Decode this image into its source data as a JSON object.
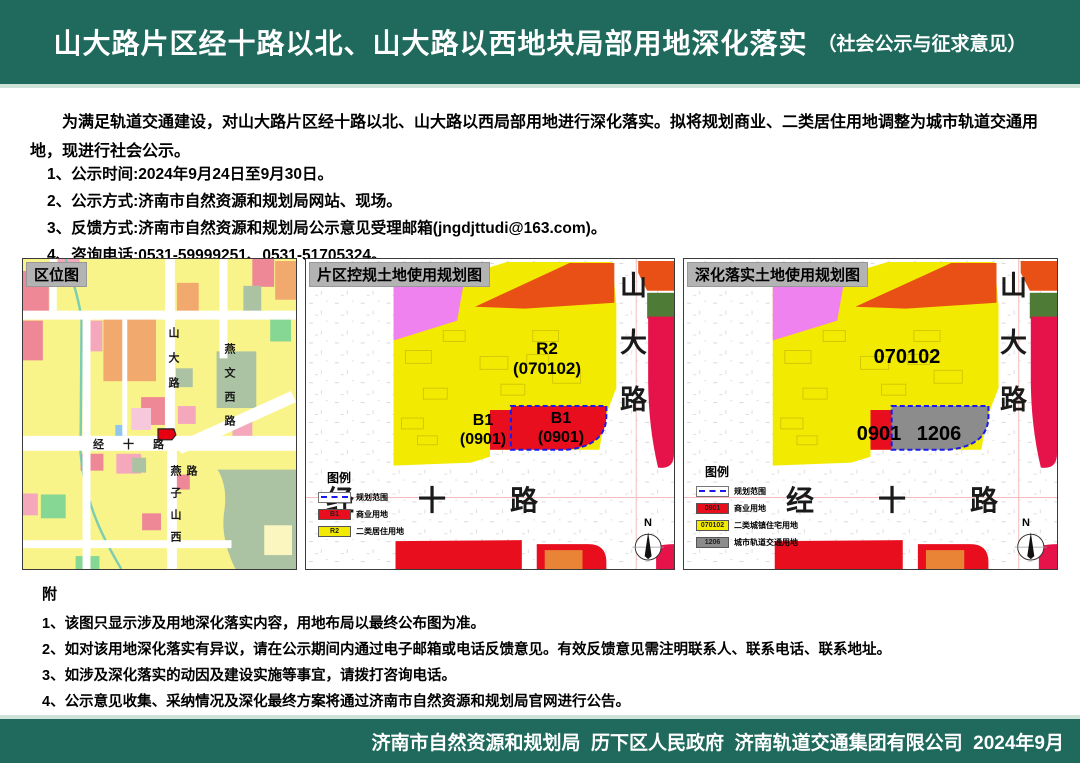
{
  "header": {
    "title": "山大路片区经十路以北、山大路以西地块局部用地深化落实",
    "subtitle": "（社会公示与征求意见）"
  },
  "intro": "为满足轨道交通建设，对山大路片区经十路以北、山大路以西局部用地进行深化落实。拟将规划商业、二类居住用地调整为城市轨道交通用地，现进行社会公示。",
  "notices": [
    "1、公示时间:2024年9月24日至9月30日。",
    "2、公示方式:济南市自然资源和规划局网站、现场。",
    "3、反馈方式:济南市自然资源和规划局公示意见受理邮箱(jngdjttudi@163.com)。",
    "4、咨询电话:0531-59999251、0531-51705324。"
  ],
  "location_panel": {
    "title": "区位图",
    "roads": {
      "shanda": "山大路",
      "yanwenxi": "燕文西路",
      "jingshi": "经十路",
      "yanzishanxi": "燕子山西路"
    }
  },
  "current_panel": {
    "title": "片区控规土地使用规划图",
    "parcel_r2_code": "R2",
    "parcel_r2_num": "(070102)",
    "parcel_b1_code": "B1",
    "parcel_b1_num": "(0901)",
    "parcel_b1_small_code": "B1",
    "parcel_b1_small_num": "(0901)",
    "roads": {
      "shanda": "山大路",
      "jingshi": "经十路"
    },
    "north": "N",
    "legend": {
      "title": "图例",
      "items": [
        {
          "code": "",
          "label": "规划范围"
        },
        {
          "code": "B1",
          "label": "商业用地"
        },
        {
          "code": "R2",
          "label": "二类居住用地"
        }
      ]
    }
  },
  "proposed_panel": {
    "title": "深化落实土地使用规划图",
    "parcel_residential": "070102",
    "parcel_commercial": "0901",
    "parcel_rail": "1206",
    "roads": {
      "shanda": "山大路",
      "jingshi": "经十路"
    },
    "north": "N",
    "legend": {
      "title": "图例",
      "items": [
        {
          "code": "",
          "label": "规划范围"
        },
        {
          "code": "0901",
          "label": "商业用地"
        },
        {
          "code": "070102",
          "label": "二类城镇住宅用地"
        },
        {
          "code": "1206",
          "label": "城市轨道交通用地"
        }
      ]
    }
  },
  "notes": {
    "heading": "附",
    "items": [
      "1、该图只显示涉及用地深化落实内容，用地布局以最终公布图为准。",
      "2、如对该用地深化落实有异议，请在公示期间内通过电子邮箱或电话反馈意见。有效反馈意见需注明联系人、联系电话、联系地址。",
      "3、如涉及深化落实的动因及建设实施等事宜，请拨打咨询电话。",
      "4、公示意见收集、采纳情况及深化最终方案将通过济南市自然资源和规划局官网进行公告。"
    ]
  },
  "footer": {
    "text": "济南市自然资源和规划局  历下区人民政府  济南轨道交通集团有限公司  2024年9月"
  },
  "colors": {
    "band_green": "#1f6a5c",
    "band_divider": "#cfe2d8",
    "map_yellow": "#f2ea00",
    "map_red": "#e80e1e",
    "map_crimson": "#e5134a",
    "map_orange_red": "#e85016",
    "map_orange": "#e98436",
    "map_magenta": "#ef82ef",
    "map_gray": "#8c8c8c",
    "map_dark_green": "#4e7b35",
    "dashed_blue": "#1a1aee",
    "loc_yellow": "#f8f48a",
    "loc_pink1": "#f5a8bc",
    "loc_pink2": "#ee8796",
    "loc_salmon": "#f2a96d",
    "loc_sage": "#abc3a3",
    "loc_green": "#86d793",
    "loc_teal": "#6fc9b6",
    "loc_blue": "#8ec6f0",
    "site_red": "#e60012"
  }
}
